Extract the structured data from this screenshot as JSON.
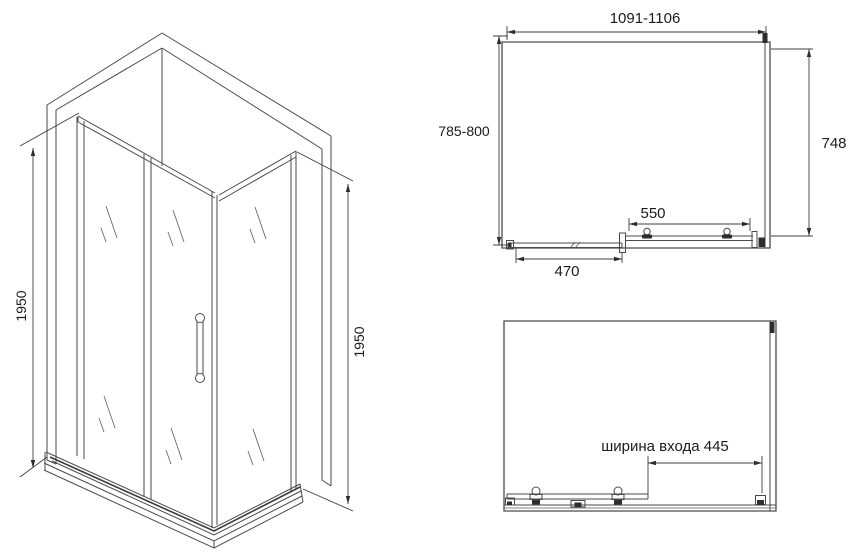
{
  "colors": {
    "background": "#ffffff",
    "line": "#4a4a4a",
    "dimension_line": "#3f3f3f",
    "text": "#1b1b1b",
    "profile_fill": "#2d2d2d"
  },
  "views": {
    "perspective": {
      "description": "corner shower enclosure with sliding door, 3d line drawing",
      "left_height": "1950",
      "right_height": "1950"
    },
    "plan": {
      "width_range": "1091-1106",
      "depth_range": "785-800",
      "glass_depth": "748",
      "door_width": "550",
      "fixed_panel_width": "470"
    },
    "front": {
      "entrance_width_label": "ширина входа 445"
    }
  }
}
